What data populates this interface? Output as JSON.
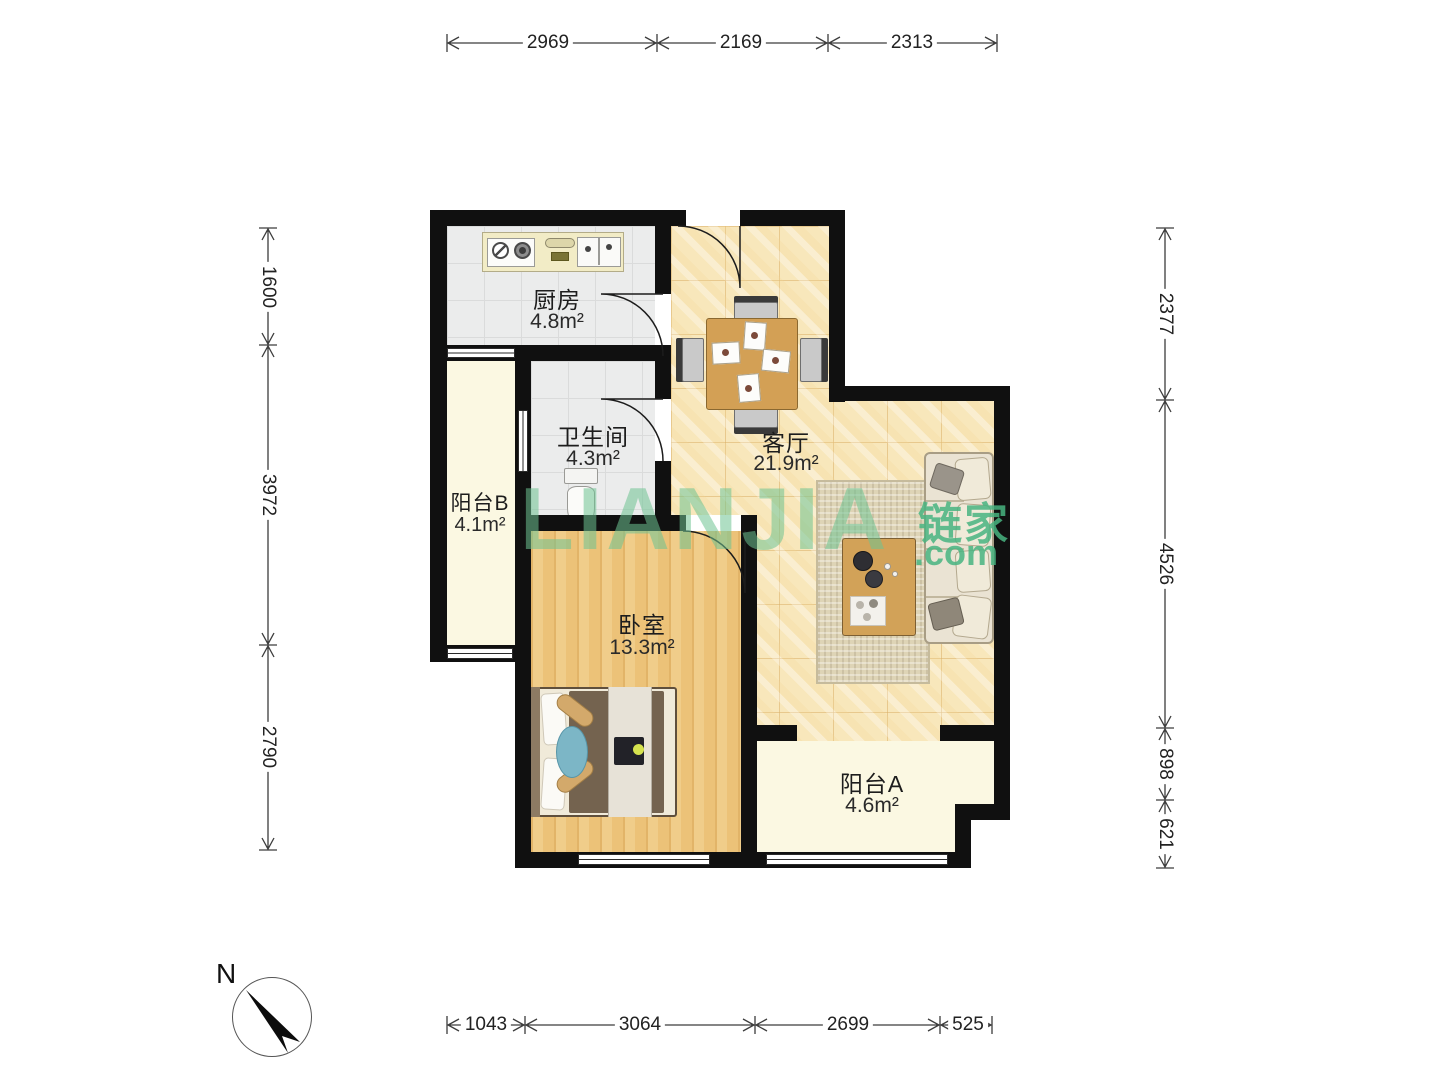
{
  "plan": {
    "rooms": [
      {
        "name": "厨房",
        "area": "4.8m²"
      },
      {
        "name": "卫生间",
        "area": "4.3m²"
      },
      {
        "name": "客厅",
        "area": "21.9m²"
      },
      {
        "name": "阳台B",
        "area": "4.1m²"
      },
      {
        "name": "卧室",
        "area": "13.3m²"
      },
      {
        "name": "阳台A",
        "area": "4.6m²"
      }
    ],
    "dims": {
      "top": [
        "2969",
        "2169",
        "2313"
      ],
      "left": [
        "1600",
        "3972",
        "2790"
      ],
      "right": [
        "2377",
        "4526",
        "898",
        "621"
      ],
      "bottom": [
        "1043",
        "3064",
        "2699",
        "525"
      ]
    },
    "compass": {
      "label": "N"
    },
    "watermark": {
      "logo": "LIANJIA",
      "brand": "链家",
      "domain": ".com"
    },
    "colors": {
      "wall": "#101010",
      "living_floor": "#f8e7bb",
      "wood_floor": "#eec77f",
      "tile_floor": "#ebecec",
      "balcony_floor": "#fbf8e2",
      "watermark_green": "#48b480"
    }
  }
}
